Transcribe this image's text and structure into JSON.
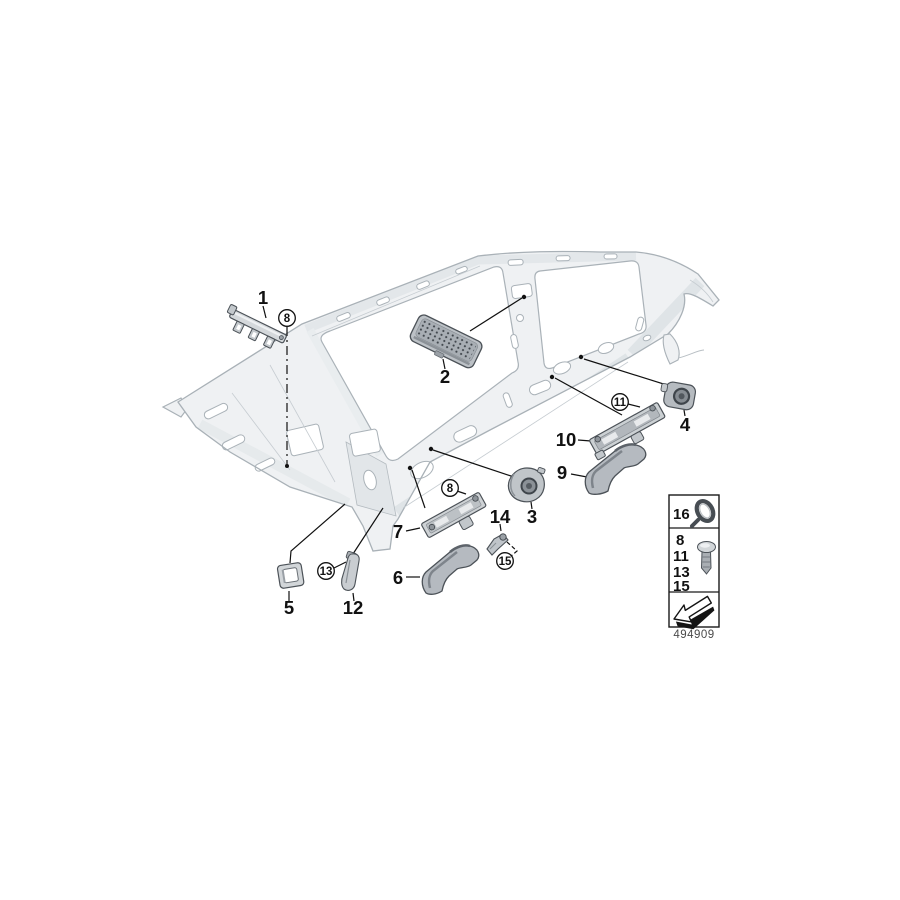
{
  "diagram": {
    "description": "Mounted parts for roofliner exploded parts diagram",
    "footer_number": "494909",
    "callouts": {
      "c1": "1",
      "c2": "2",
      "c3": "3",
      "c4": "4",
      "c5": "5",
      "c6": "6",
      "c7": "7",
      "c9": "9",
      "c10": "10",
      "c12": "12",
      "c14": "14"
    },
    "fasteners": {
      "f8": "8",
      "f11": "11",
      "f13": "13",
      "f15": "15"
    },
    "legend": {
      "row1_number": "16",
      "row2_numbers": [
        "8",
        "11",
        "13",
        "15"
      ],
      "icons": {
        "row1": "cable-strap-icon",
        "row2": "screw-icon",
        "row3": "direction-arrow-icon"
      }
    },
    "colors": {
      "callout_line": "#111111",
      "frame_stroke": "#a9b1b7",
      "frame_fill": "#eff1f3",
      "part_stroke": "#4c5258",
      "part_fill": "#c6cacd"
    }
  }
}
